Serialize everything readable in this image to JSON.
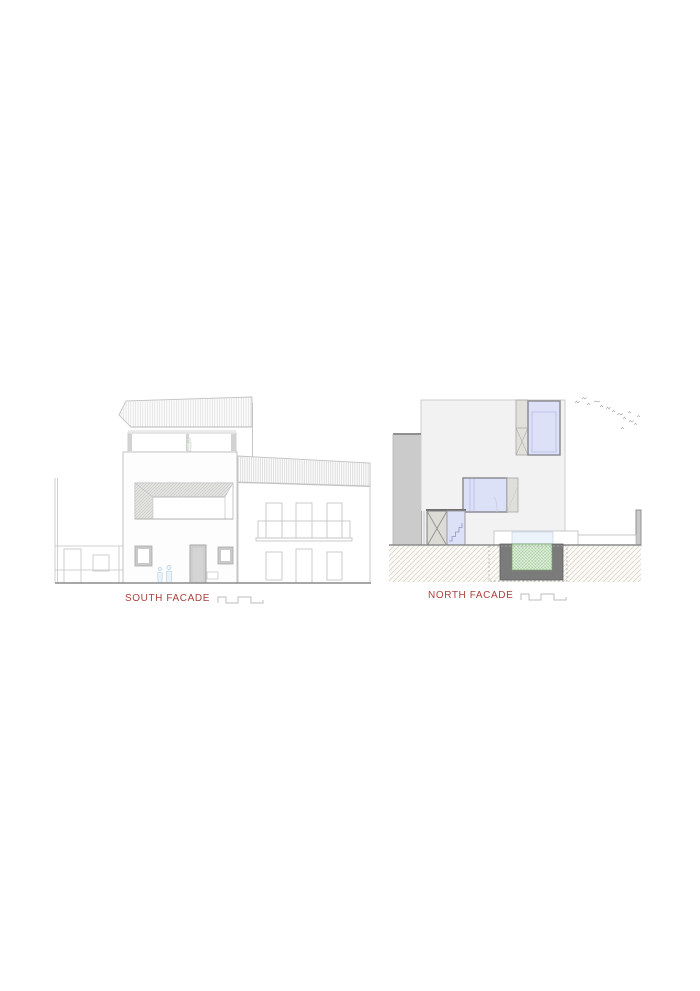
{
  "figures": {
    "south": {
      "label": "SOUTH FACADE"
    },
    "north": {
      "label": "NORTH FACADE"
    }
  },
  "colors": {
    "label_red": "#a8423c",
    "facade_gray": "#f2f2f3",
    "wall_gray": "#cbcbcb",
    "glazing_blue": "#dce1f8",
    "glazing_border": "#8d8d94",
    "pool_green": "#dfeeda",
    "pool_green_hatch": "#8fbe86",
    "pool_wall_gray": "#7b7b7b",
    "ground_hatch_line": "#dad4c9",
    "drawing_line_light": "#c3c3c3",
    "drawing_line_dark": "#8c8c8c",
    "figure_blue": "#b9d3e6"
  }
}
